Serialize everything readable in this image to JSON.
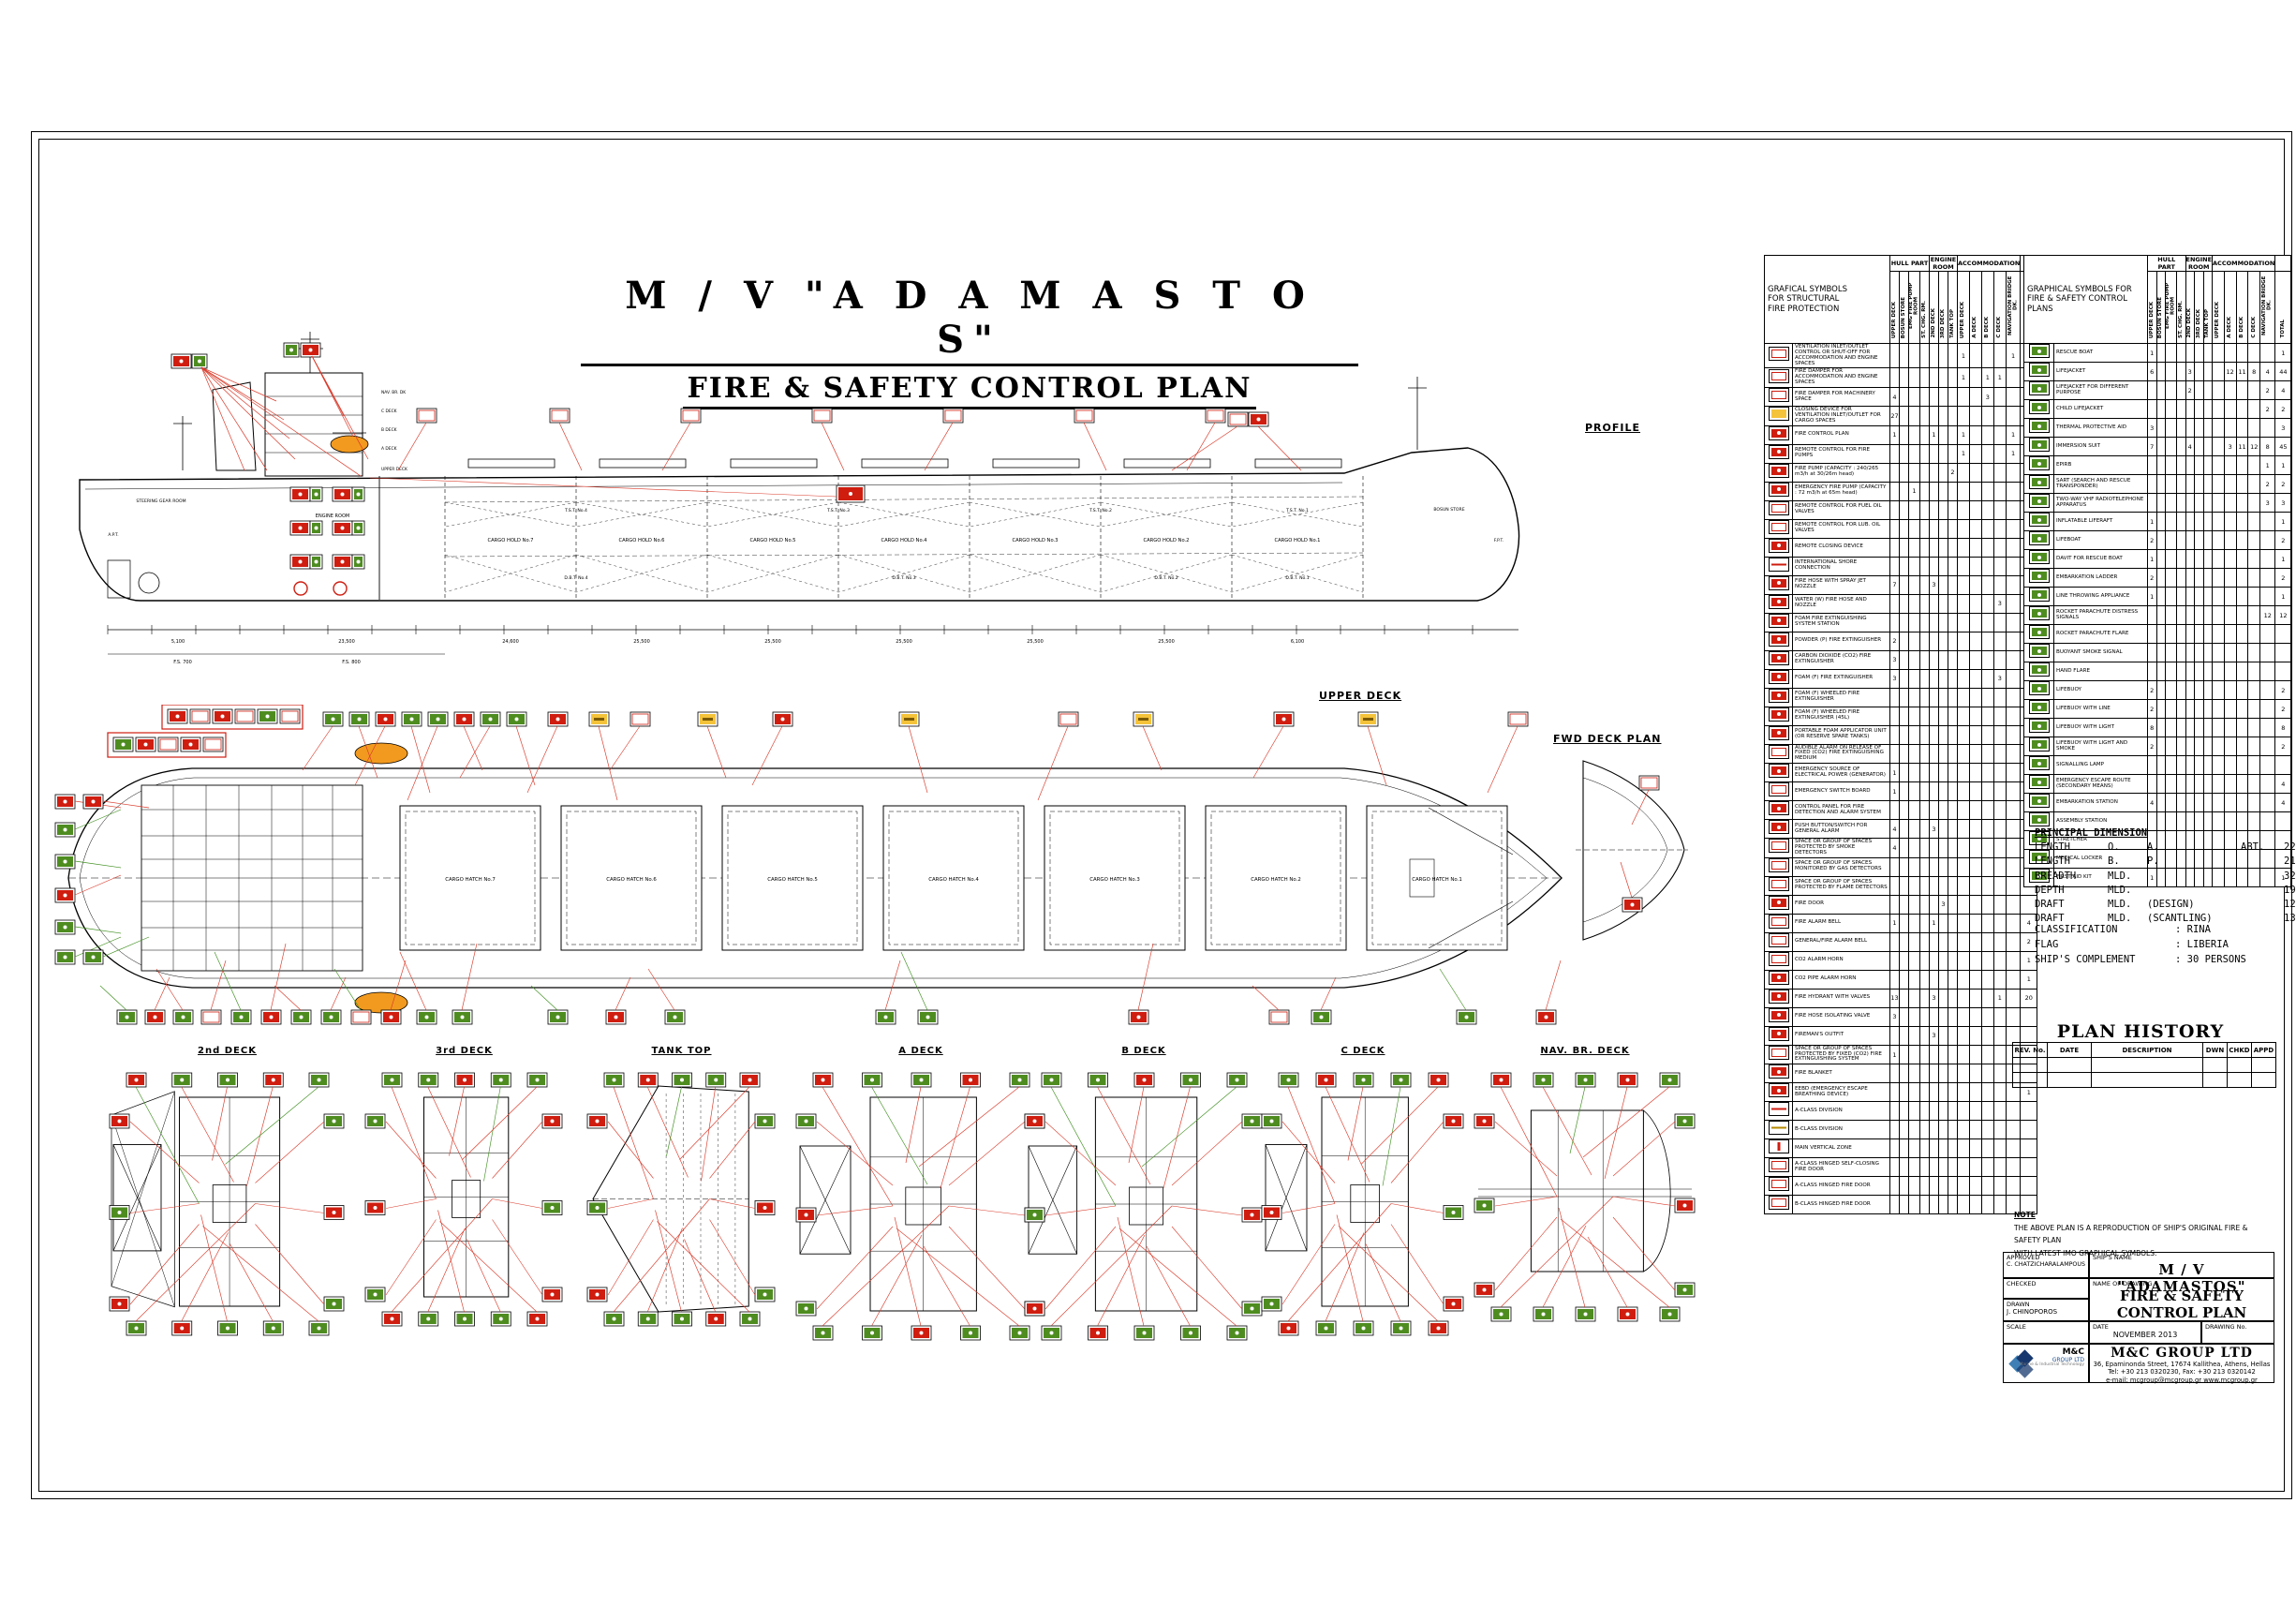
{
  "page": {
    "title_line1": "M / V   \"A D A M A S T O S\"",
    "title_line2": "FIRE & SAFETY CONTROL PLAN"
  },
  "views": {
    "profile_label": "PROFILE",
    "upper_deck_label": "UPPER DECK",
    "fwd_deck_label": "FWD DECK PLAN",
    "deck_plan_labels": [
      "2nd DECK",
      "3rd DECK",
      "TANK TOP",
      "A DECK",
      "B DECK",
      "C DECK",
      "NAV. BR. DECK"
    ],
    "cargo_holds": [
      "CARGO HOLD No.7",
      "CARGO HOLD No.6",
      "CARGO HOLD No.5",
      "CARGO HOLD No.4",
      "CARGO HOLD No.3",
      "CARGO HOLD No.2",
      "CARGO HOLD No.1"
    ],
    "cargo_hatches": [
      "CARGO HATCH No.7",
      "CARGO HATCH No.6",
      "CARGO HATCH No.5",
      "CARGO HATCH No.4",
      "CARGO HATCH No.3",
      "CARGO HATCH No.2",
      "CARGO HATCH No.1"
    ],
    "superstructure_decks": [
      "NAV. BR. DK",
      "C DECK",
      "B DECK",
      "A DECK",
      "UPPER DECK"
    ],
    "tst_tanks": [
      "T.S.T. No.4",
      "T.S.T. No.3",
      "T.S.T. No.2",
      "T.S.T. No.1"
    ],
    "dbt_tanks": [
      "D.B.T. No.4",
      "D.B.T. No.3",
      "D.B.T. No.2",
      "D.B.T. No.1"
    ],
    "rooms": {
      "steering": "STEERING GEAR ROOM",
      "engine": "ENGINE ROOM",
      "bosun": "BOSUN STORE",
      "apt": "A.P.T.",
      "fpt": "F.P.T."
    },
    "dim_labels": [
      "5,100",
      "23,500",
      "24,600",
      "25,500",
      "25,500",
      "25,500",
      "25,500",
      "25,500",
      "6,100"
    ],
    "frame_labels": [
      "F.S. 700",
      "F.S. 800"
    ]
  },
  "legend_left": {
    "title_lines": [
      "GRAFICAL SYMBOLS",
      "FOR STRUCTURAL",
      "FIRE PROTECTION"
    ],
    "groups": [
      {
        "label": "HULL PART",
        "span": 4
      },
      {
        "label": "ENGINE ROOM",
        "span": 3
      },
      {
        "label": "ACCOMMODATION",
        "span": 5
      },
      {
        "label": "",
        "span": 1
      }
    ],
    "columns": [
      "UPPER DECK",
      "BOSUN STORE",
      "EMG FIRE PUMP ROOM",
      "ST. CHG. RM.",
      "2ND DECK",
      "3RD DECK",
      "TANK TOP",
      "UPPER DECK",
      "A DECK",
      "B DECK",
      "C DECK",
      "NAVIGATION BRIDGE DK.",
      "TOTAL"
    ],
    "rows": [
      {
        "icon": "vent-shutoff-icon",
        "c": "w",
        "label": "VENTILATION INLET/OUTLET CONTROL OR SHUT-OFF FOR ACCOMMODATION AND ENGINE SPACES",
        "n": {
          "7": "1",
          "11": "1",
          "12": "2"
        }
      },
      {
        "icon": "fire-damper-accom-icon",
        "c": "w",
        "label": "FIRE DAMPER FOR ACCOMMODATION AND ENGINE SPACES",
        "n": {
          "7": "1",
          "9": "1",
          "10": "1",
          "12": "3"
        }
      },
      {
        "icon": "fire-damper-icon",
        "c": "w",
        "label": "FIRE DAMPER FOR MACHINERY SPACE",
        "n": {
          "0": "4",
          "9": "3",
          "12": "7"
        }
      },
      {
        "icon": "vent-closing-icon",
        "c": "y",
        "label": "CLOSING DEVICE FOR VENTILATION INLET/OUTLET FOR CARGO SPACES",
        "n": {
          "0": "27",
          "12": "27"
        }
      },
      {
        "icon": "fire-plan-icon",
        "c": "r",
        "label": "FIRE CONTROL PLAN",
        "n": {
          "0": "1",
          "4": "1",
          "7": "1",
          "11": "1",
          "12": "4"
        }
      },
      {
        "icon": "remote-fire-pump-icon",
        "c": "r",
        "label": "REMOTE CONTROL FOR FIRE PUMPS",
        "n": {
          "7": "1",
          "11": "1",
          "12": "2"
        }
      },
      {
        "icon": "fire-pump-icon",
        "c": "r",
        "label": "FIRE PUMP (CAPACITY : 240/265 m3/h at 30/26m head)",
        "n": {
          "6": "2",
          "12": "2"
        }
      },
      {
        "icon": "emergency-fire-pump-icon",
        "c": "r",
        "label": "EMERGENCY FIRE PUMP (CAPACITY : 72 m3/h at 65m head)",
        "n": {
          "2": "1",
          "12": "1"
        }
      },
      {
        "icon": "remote-fuel-oil-icon",
        "c": "w",
        "label": "REMOTE CONTROL FOR FUEL OIL VALVES",
        "n": {}
      },
      {
        "icon": "remote-lub-oil-icon",
        "c": "w",
        "label": "REMOTE CONTROL FOR LUB. OIL VALVES",
        "n": {}
      },
      {
        "icon": "remote-closing-icon",
        "c": "r",
        "label": "REMOTE CLOSING DEVICE",
        "n": {}
      },
      {
        "icon": "shore-connection-icon",
        "c": "rl",
        "label": "INTERNATIONAL SHORE CONNECTION",
        "n": {}
      },
      {
        "icon": "fire-hose-icon",
        "c": "r",
        "label": "FIRE HOSE WITH SPRAY JET NOZZLE",
        "n": {
          "0": "7",
          "4": "3",
          "12": "10"
        }
      },
      {
        "icon": "water-hose-icon",
        "c": "r",
        "label": "WATER (W) FIRE HOSE AND NOZZLE",
        "n": {
          "10": "3",
          "12": "5"
        }
      },
      {
        "icon": "foam-station-icon",
        "c": "r",
        "label": "FOAM FIRE EXTINGUISHING SYSTEM STATION",
        "n": {}
      },
      {
        "icon": "powder-extinguisher-icon",
        "c": "r",
        "label": "POWDER (P) FIRE EXTINGUISHER",
        "n": {
          "0": "2",
          "12": "2"
        }
      },
      {
        "icon": "co2-extinguisher-icon",
        "c": "r",
        "label": "CARBON DIOXIDE (CO2) FIRE EXTINGUISHER",
        "n": {
          "0": "3",
          "12": "8"
        }
      },
      {
        "icon": "foam-extinguisher-icon",
        "c": "r",
        "label": "FOAM (F) FIRE EXTINGUISHER",
        "n": {
          "0": "3",
          "10": "3",
          "12": "8"
        }
      },
      {
        "icon": "foam-wheeled-icon",
        "c": "r",
        "label": "FOAM (F) WHEELED FIRE EXTINGUISHER",
        "n": {}
      },
      {
        "icon": "foam-wheeled-45-icon",
        "c": "r",
        "label": "FOAM (F) WHEELED FIRE EXTINGUISHER (45L)",
        "n": {
          "12": "1"
        }
      },
      {
        "icon": "foam-applicator-icon",
        "c": "r",
        "label": "PORTABLE FOAM APPLICATOR UNIT (OR RESERVE SPARE TANKS)",
        "n": {
          "12": "1"
        }
      },
      {
        "icon": "co2-alarm-release-icon",
        "c": "w",
        "label": "AUDIBLE ALARM ON RELEASE OF FIXED (CO2) FIRE EXTINGUISHING MEDIUM",
        "n": {
          "12": "11"
        }
      },
      {
        "icon": "emergency-generator-icon",
        "c": "r",
        "label": "EMERGENCY SOURCE OF ELECTRICAL POWER (GENERATOR)",
        "n": {
          "0": "1",
          "12": "1"
        }
      },
      {
        "icon": "emergency-switchboard-icon",
        "c": "w",
        "label": "EMERGENCY SWITCH BOARD",
        "n": {
          "0": "1",
          "12": "1"
        }
      },
      {
        "icon": "fire-detection-panel-icon",
        "c": "r",
        "label": "CONTROL PANEL FOR FIRE DETECTION AND ALARM SYSTEM",
        "n": {}
      },
      {
        "icon": "general-alarm-button-icon",
        "c": "r",
        "label": "PUSH BUTTON/SWITCH FOR GENERAL ALARM",
        "n": {
          "0": "4",
          "4": "3",
          "12": "9"
        }
      },
      {
        "icon": "smoke-detector-space-icon",
        "c": "w",
        "label": "SPACE OR GROUP OF SPACES PROTECTED BY SMOKE DETECTORS",
        "n": {
          "0": "4",
          "12": "6"
        }
      },
      {
        "icon": "gas-detector-space-icon",
        "c": "w",
        "label": "SPACE OR GROUP OF SPACES MONITORED BY GAS DETECTORS",
        "n": {
          "12": "3"
        }
      },
      {
        "icon": "flame-detector-space-icon",
        "c": "w",
        "label": "SPACE OR GROUP OF SPACES PROTECTED BY FLAME DETECTORS",
        "n": {
          "12": "2"
        }
      },
      {
        "icon": "fire-door-icon",
        "c": "r",
        "label": "FIRE DOOR",
        "n": {
          "5": "3"
        }
      },
      {
        "icon": "fire-alarm-bell-icon",
        "c": "w",
        "label": "FIRE ALARM BELL",
        "n": {
          "0": "1",
          "4": "1",
          "12": "4"
        }
      },
      {
        "icon": "general-alarm-bell-icon",
        "c": "w",
        "label": "GENERAL/FIRE ALARM BELL",
        "n": {
          "12": "2"
        }
      },
      {
        "icon": "alarm-horn-icon",
        "c": "w",
        "label": "CO2 ALARM HORN",
        "n": {
          "12": "1"
        }
      },
      {
        "icon": "co2-pipe-horn-icon",
        "c": "r",
        "label": "CO2 PIPE ALARM HORN",
        "n": {
          "12": "1"
        }
      },
      {
        "icon": "fire-hydrant-icon",
        "c": "r",
        "label": "FIRE HYDRANT WITH VALVES",
        "n": {
          "0": "13",
          "4": "3",
          "10": "1",
          "12": "20"
        }
      },
      {
        "icon": "hose-isolating-valve-icon",
        "c": "r",
        "label": "FIRE HOSE ISOLATING VALVE",
        "n": {
          "0": "3"
        }
      },
      {
        "icon": "firemans-outfit-icon",
        "c": "r",
        "label": "FIREMAN'S OUTFIT",
        "n": {
          "4": "3"
        }
      },
      {
        "icon": "co2-protected-space-icon",
        "c": "w",
        "label": "SPACE OR GROUP OF SPACES PROTECTED BY FIXED (CO2) FIRE EXTINGUISHING SYSTEM",
        "n": {
          "0": "1"
        }
      },
      {
        "icon": "fire-blanket-icon",
        "c": "r",
        "label": "FIRE BLANKET",
        "n": {}
      },
      {
        "icon": "eebd-icon",
        "c": "r",
        "label": "EEBD (EMERGENCY ESCAPE BREATHING DEVICE)",
        "n": {
          "12": "1"
        }
      },
      {
        "icon": "a-class-division-icon",
        "c": "rl",
        "label": "A-CLASS DIVISION",
        "n": {}
      },
      {
        "icon": "b-class-division-icon",
        "c": "yl",
        "label": "B-CLASS DIVISION",
        "n": {}
      },
      {
        "icon": "main-vertical-zone-icon",
        "c": "rv",
        "label": "MAIN VERTICAL ZONE",
        "n": {}
      },
      {
        "icon": "a-class-self-closing-door-icon",
        "c": "w",
        "label": "A-CLASS HINGED SELF-CLOSING FIRE DOOR",
        "n": {}
      },
      {
        "icon": "a-class-door-icon",
        "c": "w",
        "label": "A-CLASS HINGED FIRE DOOR",
        "n": {}
      },
      {
        "icon": "b-class-door-icon",
        "c": "w",
        "label": "B-CLASS HINGED FIRE DOOR",
        "n": {}
      }
    ]
  },
  "legend_right": {
    "title_lines": [
      "GRAPHICAL SYMBOLS FOR",
      "FIRE & SAFETY CONTROL PLANS"
    ],
    "groups": [
      {
        "label": "HULL PART",
        "span": 4
      },
      {
        "label": "ENGINE ROOM",
        "span": 3
      },
      {
        "label": "ACCOMMODATION",
        "span": 5
      },
      {
        "label": "",
        "span": 1
      }
    ],
    "columns": [
      "UPPER DECK",
      "BOSUN STORE",
      "EMG FIRE PUMP ROOM",
      "ST. CHG. RM.",
      "2ND DECK",
      "3RD DECK",
      "TANK TOP",
      "UPPER DECK",
      "A DECK",
      "B DECK",
      "C DECK",
      "NAVIGATION BRIDGE DK.",
      "TOTAL"
    ],
    "rows": [
      {
        "icon": "rescue-boat-icon",
        "c": "g",
        "label": "RESCUE BOAT",
        "n": {
          "0": "1",
          "12": "1"
        }
      },
      {
        "icon": "lifejacket-icon",
        "c": "g",
        "label": "LIFEJACKET",
        "n": {
          "0": "6",
          "4": "3",
          "8": "12",
          "9": "11",
          "10": "8",
          "11": "4",
          "12": "44"
        }
      },
      {
        "icon": "lifejacket-different-icon",
        "c": "g",
        "label": "LIFEJACKET FOR DIFFERENT PURPOSE",
        "n": {
          "4": "2",
          "11": "2",
          "12": "4"
        }
      },
      {
        "icon": "child-lifejacket-icon",
        "c": "g",
        "label": "CHILD LIFEJACKET",
        "n": {
          "11": "2",
          "12": "2"
        }
      },
      {
        "icon": "thermal-protective-aid-icon",
        "c": "g",
        "label": "THERMAL PROTECTIVE AID",
        "n": {
          "0": "3",
          "12": "3"
        }
      },
      {
        "icon": "immersion-suit-icon",
        "c": "g",
        "label": "IMMERSION SUIT",
        "n": {
          "0": "7",
          "4": "4",
          "8": "3",
          "9": "11",
          "10": "12",
          "11": "8",
          "12": "45"
        }
      },
      {
        "icon": "epirb-icon",
        "c": "g",
        "label": "EPIRB",
        "n": {
          "11": "1",
          "12": "1"
        }
      },
      {
        "icon": "sart-icon",
        "c": "g",
        "label": "SART (SEARCH AND RESCUE TRANSPONDER)",
        "n": {
          "11": "2",
          "12": "2"
        }
      },
      {
        "icon": "two-way-vhf-icon",
        "c": "g",
        "label": "TWO-WAY VHF RADIOTELEPHONE APPARATUS",
        "n": {
          "11": "3",
          "12": "3"
        }
      },
      {
        "icon": "liferaft-icon",
        "c": "g",
        "label": "INFLATABLE LIFERAFT",
        "n": {
          "0": "1",
          "12": "1"
        }
      },
      {
        "icon": "lifeboat-icon",
        "c": "g",
        "label": "LIFEBOAT",
        "n": {
          "0": "2",
          "12": "2"
        }
      },
      {
        "icon": "rescue-boat-davit-icon",
        "c": "g",
        "label": "DAVIT FOR RESCUE BOAT",
        "n": {
          "0": "1",
          "12": "1"
        }
      },
      {
        "icon": "embarkation-ladder-icon",
        "c": "g",
        "label": "EMBARKATION LADDER",
        "n": {
          "0": "2",
          "12": "2"
        }
      },
      {
        "icon": "line-throwing-icon",
        "c": "g",
        "label": "LINE THROWING APPLIANCE",
        "n": {
          "0": "1",
          "12": "1"
        }
      },
      {
        "icon": "rocket-parachute-signals-icon",
        "c": "g",
        "label": "ROCKET PARACHUTE DISTRESS SIGNALS",
        "n": {
          "11": "12",
          "12": "12"
        }
      },
      {
        "icon": "rocket-flare-icon",
        "c": "g",
        "label": "ROCKET PARACHUTE FLARE",
        "n": {}
      },
      {
        "icon": "buoyant-smoke-icon",
        "c": "g",
        "label": "BUOYANT SMOKE SIGNAL",
        "n": {}
      },
      {
        "icon": "hand-flare-icon",
        "c": "g",
        "label": "HAND FLARE",
        "n": {}
      },
      {
        "icon": "lifebuoy-icon",
        "c": "g",
        "label": "LIFEBUOY",
        "n": {
          "0": "2",
          "12": "2"
        }
      },
      {
        "icon": "lifebuoy-line-icon",
        "c": "g",
        "label": "LIFEBUOY WITH LINE",
        "n": {
          "0": "2",
          "12": "2"
        }
      },
      {
        "icon": "lifebuoy-light-icon",
        "c": "g",
        "label": "LIFEBUOY WITH LIGHT",
        "n": {
          "0": "8",
          "12": "8"
        }
      },
      {
        "icon": "lifebuoy-light-smoke-icon",
        "c": "g",
        "label": "LIFEBUOY WITH LIGHT AND SMOKE",
        "n": {
          "0": "2",
          "12": "2"
        }
      },
      {
        "icon": "signalling-lamp-icon",
        "c": "g",
        "label": "SIGNALLING LAMP",
        "n": {}
      },
      {
        "icon": "escape-route-icon",
        "c": "g",
        "label": "EMERGENCY ESCAPE ROUTE (SECONDARY MEANS)",
        "n": {
          "12": "4"
        }
      },
      {
        "icon": "embarkation-station-icon",
        "c": "g",
        "label": "EMBARKATION STATION",
        "n": {
          "0": "4",
          "12": "4"
        }
      },
      {
        "icon": "assembly-station-icon",
        "c": "g",
        "label": "ASSEMBLY STATION",
        "n": {}
      },
      {
        "icon": "stretcher-icon",
        "c": "g",
        "label": "STRETCHER",
        "n": {}
      },
      {
        "icon": "medical-locker-icon",
        "c": "g",
        "label": "MEDICAL LOCKER",
        "n": {}
      },
      {
        "icon": "first-aid-kit-icon",
        "c": "g",
        "label": "FIRST AID KIT",
        "n": {
          "0": "1",
          "12": "1"
        }
      }
    ]
  },
  "principal_dimensions": {
    "title": "PRINCIPAL DIMENSION",
    "rows": [
      [
        "LENGTH",
        "O.",
        "A.",
        "ABT.",
        "225  M"
      ],
      [
        "LENGTH",
        "B.",
        "P.",
        "",
        "217  M"
      ],
      [
        "BREADTH",
        "MLD.",
        "",
        "",
        "32.25 M"
      ],
      [
        "DEPTH",
        "MLD.",
        "",
        "",
        "19   M"
      ],
      [
        "DRAFT",
        "MLD.",
        "(DESIGN)",
        "",
        "12.40 M"
      ],
      [
        "DRAFT",
        "MLD.",
        "(SCANTLING)",
        "",
        "13.75 M"
      ]
    ]
  },
  "particulars": [
    [
      "CLASSIFICATION",
      ": RINA"
    ],
    [
      "FLAG",
      ": LIBERIA"
    ],
    [
      "SHIP'S COMPLEMENT",
      ": 30 PERSONS"
    ]
  ],
  "plan_history": {
    "title": "PLAN HISTORY",
    "columns": [
      "REV. No.",
      "DATE",
      "DESCRIPTION",
      "DWN",
      "CHKD",
      "APPD"
    ],
    "empty_rows": 2
  },
  "note": {
    "title": "NOTE",
    "lines": [
      "THE ABOVE PLAN IS A REPRODUCTION OF SHIP'S ORIGINAL FIRE & SAFETY PLAN",
      "WITH LATEST IMO GRAPHICAL SYMBOLS."
    ]
  },
  "title_block": {
    "approved_label": "APPROVED",
    "approved": "C. CHATZICHARALAMPOUS",
    "checked_label": "CHECKED",
    "drawn_label": "DRAWN",
    "drawn": "J. CHINOPOROS",
    "scale_label": "SCALE",
    "ships_name_label": "SHIP'S NAME",
    "ships_name": "M / V   \"ADAMASTOS\"",
    "drawing_name_label": "NAME OF DRAWING",
    "drawing_name_1": "FIRE & SAFETY",
    "drawing_name_2": "CONTROL PLAN",
    "date_label": "DATE",
    "date": "NOVEMBER 2013",
    "drawing_no_label": "DRAWING No.",
    "company": "M&C  GROUP  LTD",
    "address": "36, Epaminonda Street, 17674 Kallithea, Athens, Hellas",
    "tel": "Tel: +30 213 0320230, Fax: +30 213 0320142",
    "email": "e-mail: mcgroup@mcgroup.gr    www.mcgroup.gr",
    "logo_l1": "M&C",
    "logo_l2": "GROUP LTD",
    "logo_l3": "Marine & Industrial Technology"
  },
  "colors": {
    "symbol_red": "#cf1d10",
    "symbol_green": "#4e8c20",
    "symbol_yellow": "#f5c33a",
    "lifeboat_orange": "#f29a1f",
    "leader_red": "#d93a2a",
    "leader_green": "#3f8f1f",
    "logo_blue_dark": "#17386e",
    "logo_blue_light": "#3e7fb5"
  }
}
